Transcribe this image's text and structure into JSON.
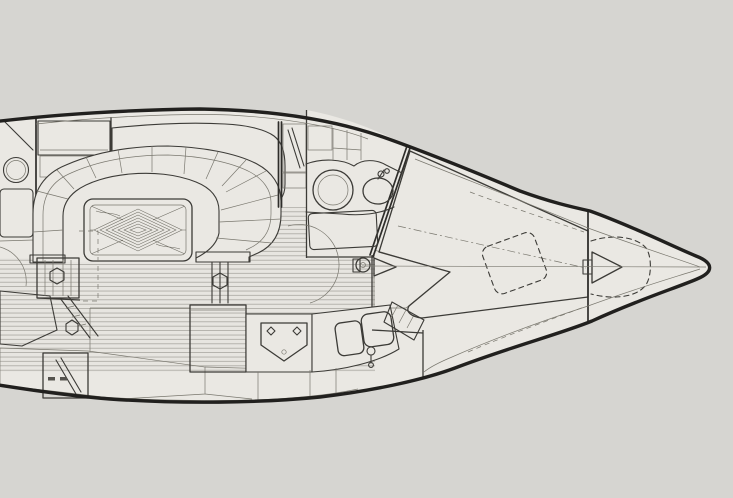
{
  "meta": {
    "title": "Sailboat interior layout plan",
    "view": "Overhead accommodation plan, bow pointing right, stern cropped at left edge"
  },
  "palette": {
    "paper": "#d6d5d1",
    "interior": "#eae8e3",
    "line": "#3c3b37",
    "hull_line": "#21201e",
    "faint_line": "#82807a",
    "cushion_base": "#d0cec7",
    "grate_base": "#e2e0da",
    "wood_line": "#6b6960"
  },
  "regions": [
    {
      "id": "hull-outline",
      "label": "hull and deck outline"
    },
    {
      "id": "cabin-sole-planking",
      "label": "teak cabin sole planking"
    },
    {
      "id": "aft-cabin-compartment",
      "label": "aft compartment (cropped at left)"
    },
    {
      "id": "aft-washbasin",
      "label": "aft cabin round basin"
    },
    {
      "id": "aft-berth-cushion",
      "label": "aft berth cushion (hatched)"
    },
    {
      "id": "seatback-cushion",
      "label": "settee back cushion (hatched)"
    },
    {
      "id": "u-settee",
      "label": "U-shaped dinette settee"
    },
    {
      "id": "dinette-table",
      "label": "dinette table with mitred parquet top"
    },
    {
      "id": "table-pedestal-left",
      "label": "table pedestal box"
    },
    {
      "id": "table-pedestal-right",
      "label": "table support post"
    },
    {
      "id": "folding-leg-ladder",
      "label": "folding leg / step frame"
    },
    {
      "id": "hanging-locker",
      "label": "hanging locker"
    },
    {
      "id": "head-compartment",
      "label": "head (washroom) compartment"
    },
    {
      "id": "toilet",
      "label": "marine toilet"
    },
    {
      "id": "head-washbasin",
      "label": "head washbasin with tap"
    },
    {
      "id": "shower-grate",
      "label": "shower floor grating"
    },
    {
      "id": "head-door-arc",
      "label": "head door swing"
    },
    {
      "id": "mast",
      "label": "keel-stepped mast"
    },
    {
      "id": "galley-cabinet",
      "label": "galley wood cabinet / icebox"
    },
    {
      "id": "galley-stove",
      "label": "gimballed stove with burners"
    },
    {
      "id": "galley-double-sink",
      "label": "galley double sink with faucet"
    },
    {
      "id": "louvered-locker",
      "label": "louvered locker front"
    },
    {
      "id": "quarter-berth-cushion",
      "label": "quarter berth cushion (hatched)"
    },
    {
      "id": "wood-floor-locker",
      "label": "wood-grain locker band"
    },
    {
      "id": "companionway-steps",
      "label": "step box"
    },
    {
      "id": "v-berth-cushion",
      "label": "V-berth cushion (hatched)"
    },
    {
      "id": "overhead-hatch",
      "label": "overhead hatch (dashed)"
    },
    {
      "id": "forepeak-bulkhead",
      "label": "forepeak bulkhead"
    },
    {
      "id": "anchor-locker",
      "label": "anchor locker (dashed)"
    },
    {
      "id": "stem-fitting",
      "label": "bow stem fitting"
    },
    {
      "id": "bow-centerline",
      "label": "centerline"
    }
  ]
}
